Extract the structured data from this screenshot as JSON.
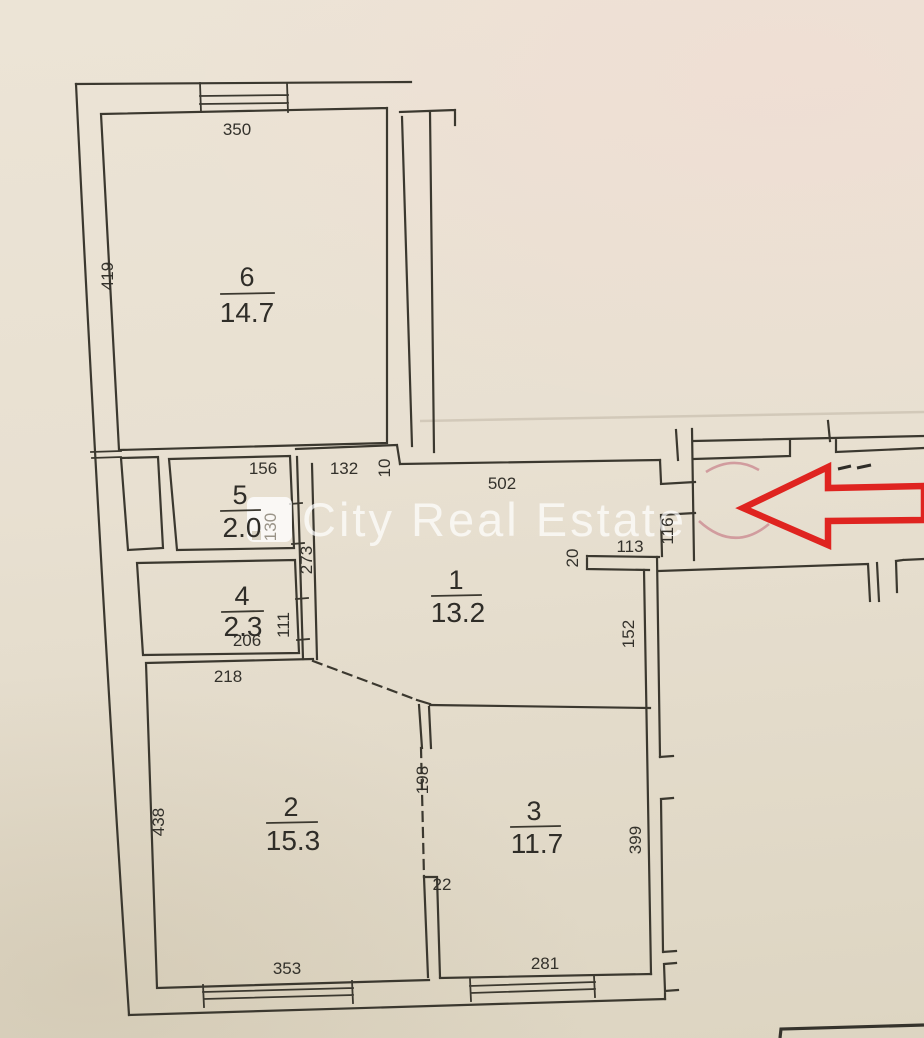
{
  "watermark": {
    "text": "City Real Estate"
  },
  "rooms": {
    "r1": {
      "number": "1",
      "area": "13.2"
    },
    "r2": {
      "number": "2",
      "area": "15.3"
    },
    "r3": {
      "number": "3",
      "area": "11.7"
    },
    "r4": {
      "number": "4",
      "area": "2.3"
    },
    "r5": {
      "number": "5",
      "area": "2.0"
    },
    "r6": {
      "number": "6",
      "area": "14.7"
    }
  },
  "dims": {
    "d350": "350",
    "d419": "419",
    "d156": "156",
    "d132": "132",
    "d10": "10",
    "d502": "502",
    "d130": "130",
    "d273": "273",
    "d111": "111",
    "d206": "206",
    "d218": "218",
    "d113": "113",
    "d20": "20",
    "d116": "116",
    "d152": "152",
    "d438": "438",
    "d198": "198",
    "d22": "22",
    "d353": "353",
    "d281": "281",
    "d399": "399"
  },
  "annotations": {
    "arrow_direction": "left"
  },
  "colors": {
    "paper": "#e8e0d1",
    "line": "#3b382f",
    "arrow": "#df2420",
    "door_arc": "#c9868e",
    "watermark": "rgba(255,255,255,0.7)"
  }
}
